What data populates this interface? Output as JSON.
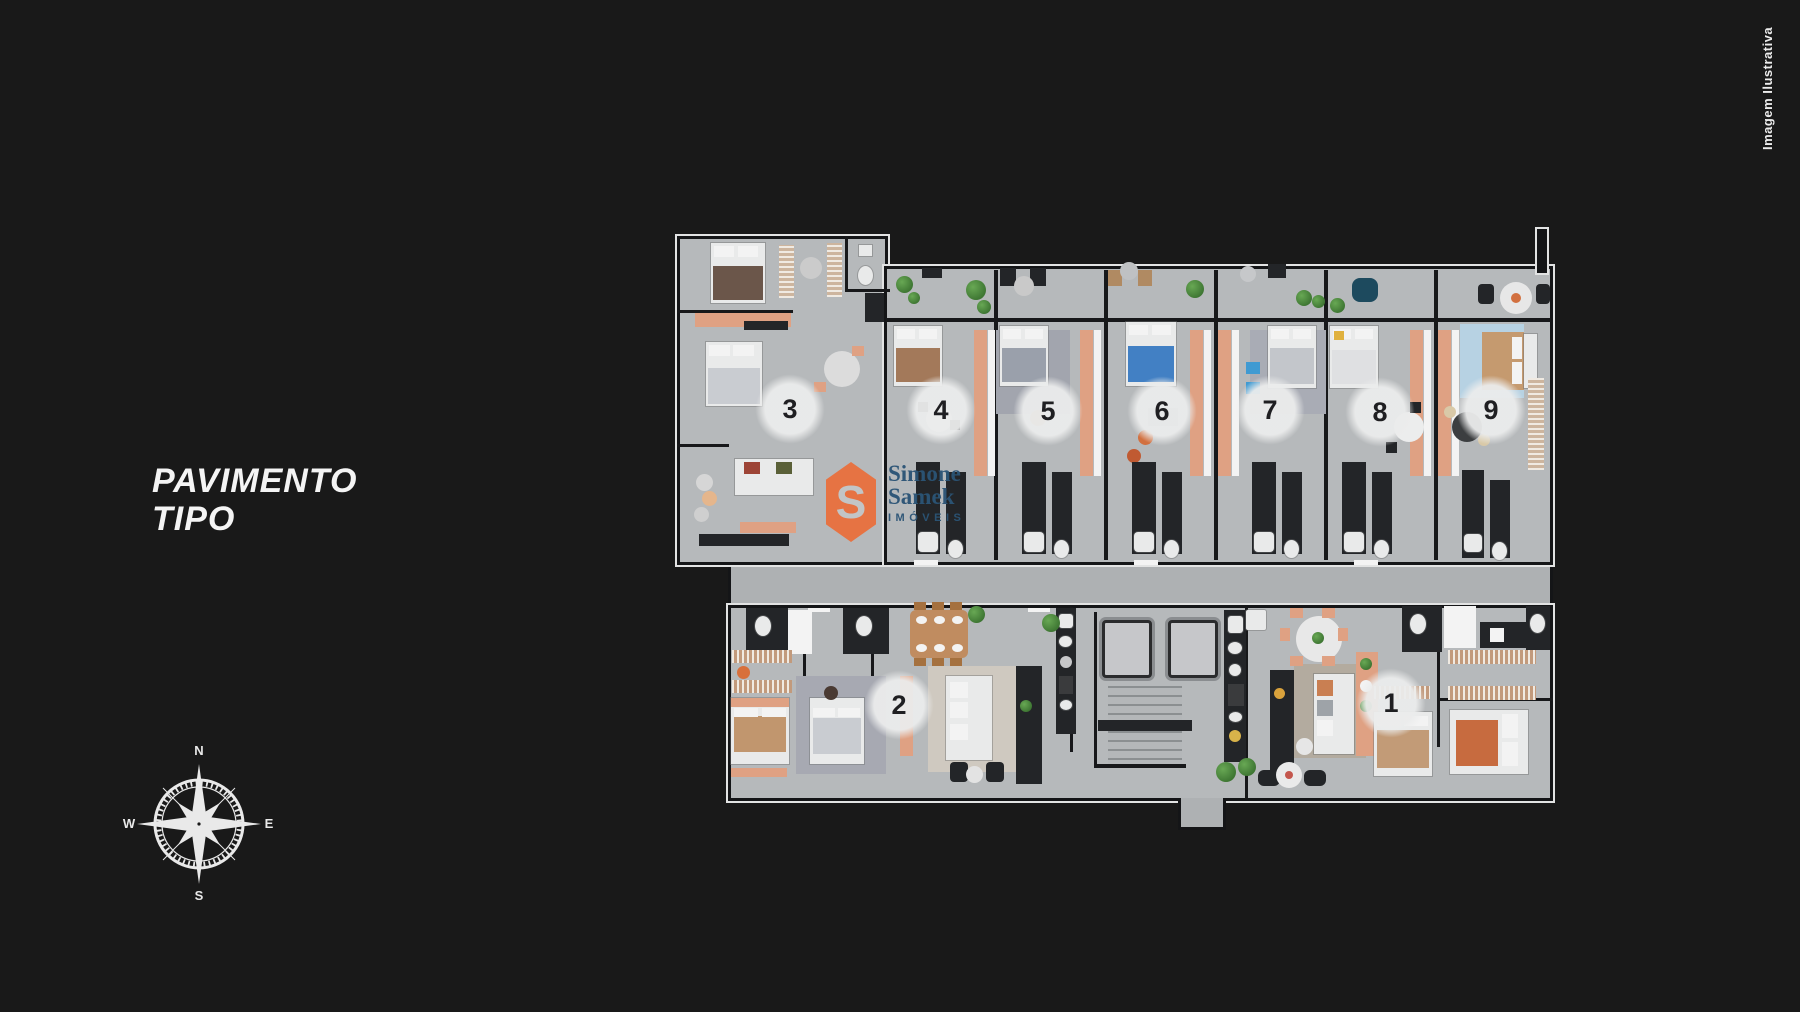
{
  "page": {
    "background_color": "#191919"
  },
  "title": {
    "line1": "PAVIMENTO",
    "line2": "TIPO"
  },
  "disclaimer": {
    "text": "Imagem Ilustrativa"
  },
  "logo": {
    "badge_letter": "S",
    "name_line1": "Simone",
    "name_line2": "Samek",
    "tagline": "IMÓVEIS",
    "badge_color": "#e8713f",
    "text_color": "#2b5476"
  },
  "compass": {
    "north": "N",
    "east": "E",
    "south": "S",
    "west": "W"
  },
  "floorplan": {
    "unit_labels": [
      {
        "number": "1",
        "x": 1391,
        "y": 703
      },
      {
        "number": "2",
        "x": 899,
        "y": 705
      },
      {
        "number": "3",
        "x": 790,
        "y": 409
      },
      {
        "number": "4",
        "x": 941,
        "y": 410
      },
      {
        "number": "5",
        "x": 1048,
        "y": 411
      },
      {
        "number": "6",
        "x": 1162,
        "y": 411
      },
      {
        "number": "7",
        "x": 1270,
        "y": 410
      },
      {
        "number": "8",
        "x": 1380,
        "y": 412
      },
      {
        "number": "9",
        "x": 1491,
        "y": 410
      }
    ]
  },
  "colors": {
    "floor": "#b6b9bb",
    "corridor_floor": "#aeb1b3",
    "wall": "#17181a",
    "wall_trim": "#e2e3e3",
    "kitchen_accent": "#dfa183",
    "badge_text": "#1f1f22"
  }
}
